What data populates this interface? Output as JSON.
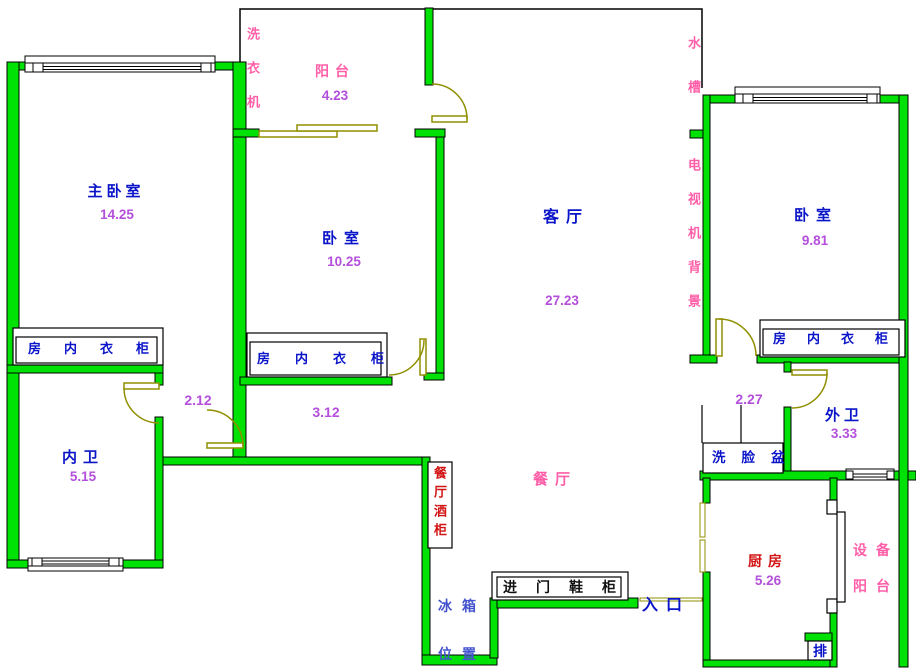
{
  "plan": {
    "rooms": {
      "master_bedroom": {
        "name": "主卧室",
        "area": "14.25"
      },
      "bedroom_2": {
        "name": "卧室",
        "area": "10.25"
      },
      "bedroom_3": {
        "name": "卧室",
        "area": "9.81"
      },
      "living_room": {
        "name": "客厅",
        "area": "27.23"
      },
      "dining_room": {
        "name": "餐厅"
      },
      "balcony": {
        "name": "阳台",
        "area": "4.23"
      },
      "inner_bathroom": {
        "name": "内卫",
        "area": "5.15"
      },
      "outer_bathroom": {
        "name": "外卫",
        "area": "3.33"
      },
      "kitchen": {
        "name": "厨房",
        "area": "5.26"
      },
      "equipment_balcony": {
        "name_line1": "设备",
        "name_line2": "阳台"
      }
    },
    "hall_dimensions": {
      "master_hall_width": "2.12",
      "corridor_width": "3.12",
      "bath_hall_width": "2.27"
    },
    "fixtures": {
      "washing_machine": "洗衣机",
      "water_sink": "水槽",
      "tv_background": "电视机背景",
      "wardrobe": "房内衣柜",
      "wine_cabinet": "餐厅酒柜",
      "wash_basin": "洗脸盆",
      "shoe_cabinet": "进门鞋柜",
      "fridge_line1": "冰箱",
      "fridge_line2": "位置",
      "entrance": "入口",
      "duct": "排"
    },
    "colors": {
      "wall_green": "#00E106",
      "door_olive": "#8F8F00",
      "room_label_blue": "#0A14C8",
      "area_purple": "#B44FDC",
      "feature_pink": "#FF5FA8",
      "cabinet_red": "#D21414"
    }
  }
}
